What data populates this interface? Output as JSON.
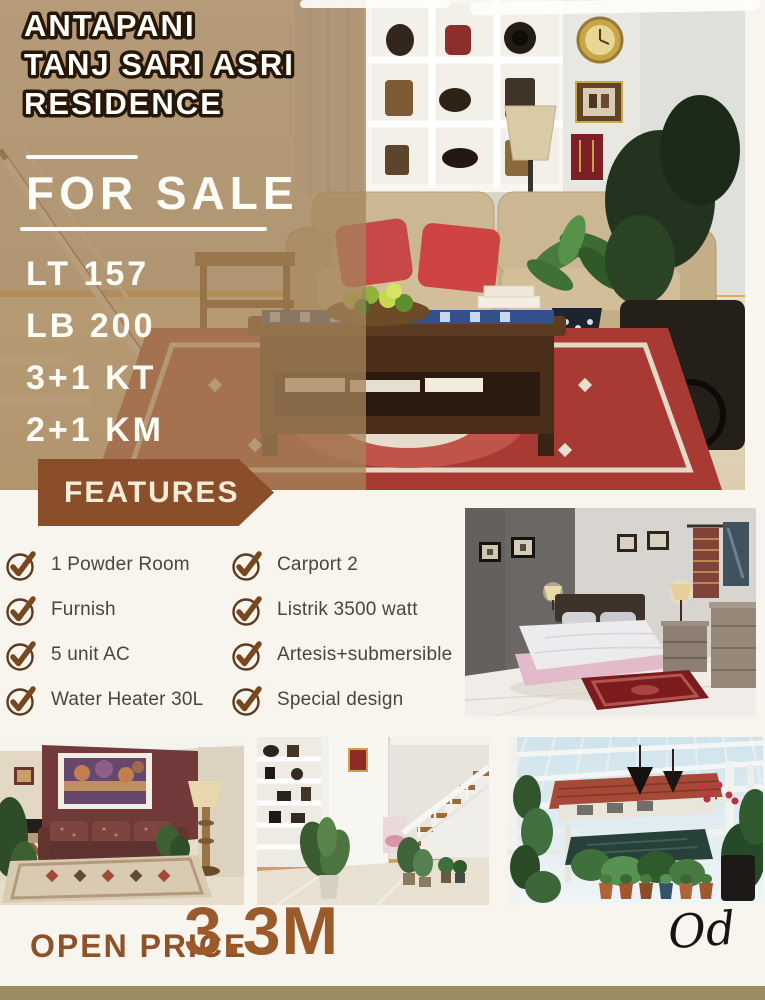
{
  "poster": {
    "title": {
      "line1": "ANTAPANI",
      "line2": "TANJ SARI ASRI",
      "line3": "RESIDENCE"
    },
    "sale_banner": "FOR SALE",
    "specs": [
      "LT 157",
      "LB 200",
      "3+1 KT",
      "2+1 KM"
    ],
    "features": {
      "header": "FEATURES",
      "left": [
        "1 Powder Room",
        "Furnish",
        "5 unit AC",
        "Water Heater 30L"
      ],
      "right": [
        "Carport 2",
        "Listrik 3500 watt",
        "Artesis+submersible",
        "Special design"
      ]
    },
    "price": {
      "label": "OPEN PRICE",
      "value": "3.3M"
    },
    "signature": "Od",
    "icons": {
      "feature_bullet": "check-circle-icon"
    },
    "colors": {
      "ribbon_brown": "#8a4e2b",
      "price_brown": "#9a5a2a",
      "footer_bar": "#9c8c61",
      "overlay_tan": "#a48359",
      "check_brown": "#77471e",
      "title_fill": "#fffef8",
      "title_outline": "#271709",
      "body_text": "#4a453f",
      "background_cream": "#f8f5ee"
    }
  }
}
